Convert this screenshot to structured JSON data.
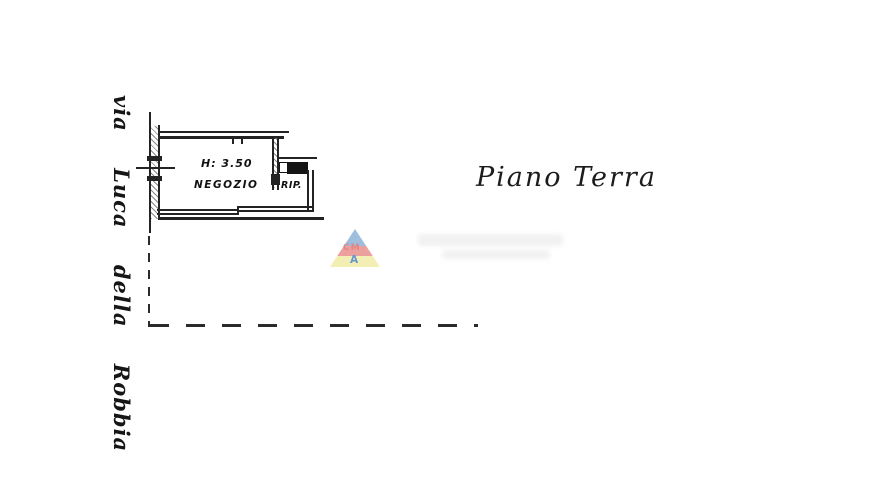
{
  "plan": {
    "floor_title": "Piano Terra",
    "street_name": "via Luca della Robbia",
    "shop_room": {
      "label": "NEGOZIO",
      "ceiling_height": "H: 3.50"
    },
    "storage_room": {
      "label": "RIP."
    }
  },
  "watermark": {
    "mid_letters": "CM",
    "bottom_letter": "A",
    "colors": {
      "blue": "#8fb3d9",
      "red": "#e8908d",
      "yellow": "#f2eca6",
      "letter_red": "#e06a66",
      "letter_blue": "#4a86c8"
    }
  }
}
